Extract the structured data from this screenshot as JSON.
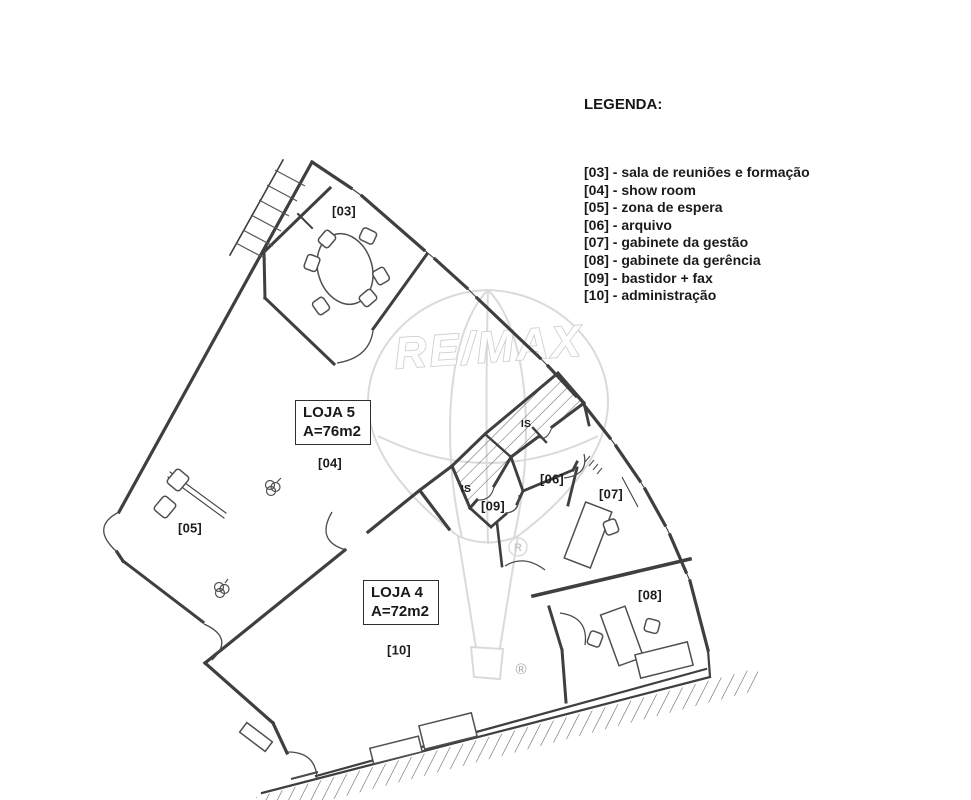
{
  "legend": {
    "title": "LEGENDA:",
    "items": [
      "[03] - sala de reuniões e formação",
      "[04] - show room",
      "[05] - zona de espera",
      "[06] - arquivo",
      "[07] - gabinete da gestão",
      "[08] - gabinete da gerência",
      "[09] - bastidor + fax",
      "[10] - administração"
    ]
  },
  "units": {
    "loja5": {
      "name": "LOJA 5",
      "area": "A=76m2"
    },
    "loja4": {
      "name": "LOJA 4",
      "area": "A=72m2"
    }
  },
  "room_labels": {
    "r03": "[03]",
    "r04": "[04]",
    "r05": "[05]",
    "r06": "[06]",
    "r07": "[07]",
    "r08": "[08]",
    "r09": "[09]",
    "r10": "[10]",
    "is_upper": "IS",
    "is_lower": "IS"
  },
  "watermark": {
    "brand": "RE/MAX",
    "registered": "®",
    "registered_small": "R"
  },
  "colors": {
    "line": "#3f3f3f",
    "watermark": "#d9d9d9",
    "paper": "#ffffff"
  }
}
